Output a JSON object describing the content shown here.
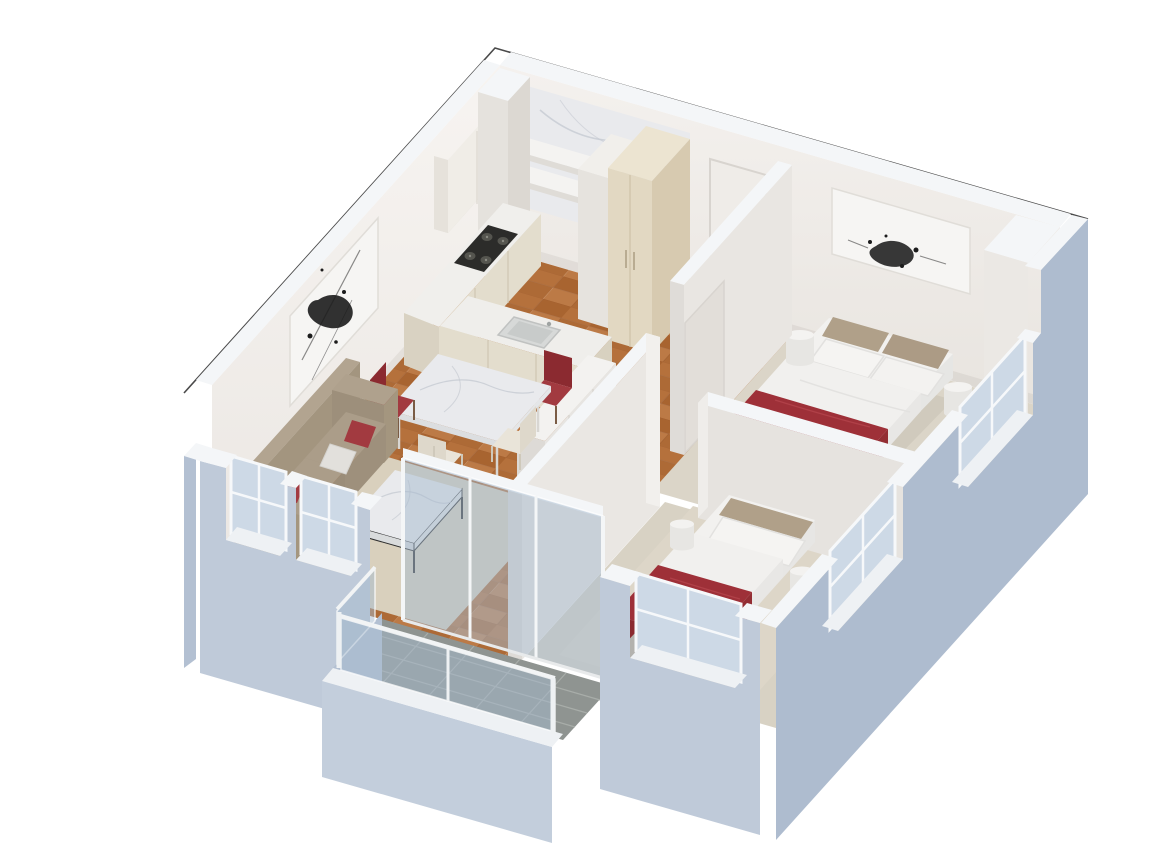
{
  "meta": {
    "width": 1170,
    "height": 859,
    "view": "3d-isometric-cutaway-floor-plan",
    "style": "architectural render, white background",
    "background": "#ffffff"
  },
  "palette": {
    "wood_1": "#b5713c",
    "wood_2": "#a86430",
    "wood_3": "#ad6a36",
    "wood_4": "#bc7a46",
    "carpet_bedroom1": "#dbd5c8",
    "carpet_bedroom2": "#d8d2c4",
    "rug_living": "#d9d0bd",
    "rug_bedroom2": "#ddd6c8",
    "balcony_tile": "#8f9491",
    "balcony_grout": "#a8ada9",
    "marble": "#e9eaed",
    "marble_vein": "#c6cad2",
    "linen_white": "#f2f1ef",
    "accent_red": "#9e3038",
    "accent_red_dark": "#8b2a30",
    "accent_red_mid": "#932d33",
    "pillow_red": "#a23a40",
    "sofa_taupe": "#ab9d89",
    "headboard_taupe": "#b0a089",
    "window_glass": "#cdd9e6",
    "balustrade_glass": "rgba(165,185,205,0.5)",
    "exterior_sw": "#bfcad9",
    "exterior_se": "#aebccf",
    "exterior_w": "#b3c0d2",
    "wall_top": "#f4f6f8",
    "window_sill": "#eef1f4",
    "window_frame": "#f6f8fa",
    "interior_wall_light": "#f4f1ee",
    "interior_wall_shade": "#e8e4df",
    "cabinet_cream": "#e3ddcd",
    "cabinet_beige": "#e2d8c2",
    "stove_black": "#2c2c2a",
    "threshold_dark": "#3f403e",
    "artwork_ink": "#1c1c1c",
    "cut_outline": "#4a4a4a"
  },
  "scene": {
    "rooms": [
      {
        "id": "kitchen",
        "name": "kitchen",
        "floor": "wood-parquet",
        "furniture": [
          "marble-backsplash",
          "open-shelves",
          "upper-cabinets",
          "stove-counter",
          "sink-counter",
          "tall-beige-cabinet",
          "duct-column",
          "white-cabinet"
        ]
      },
      {
        "id": "entry-hall",
        "name": "entry hall",
        "floor": "wood-parquet",
        "furniture": [
          "entry-door"
        ]
      },
      {
        "id": "bedroom-1",
        "name": "master bedroom",
        "floor": "carpet",
        "furniture": [
          "double-bed-red-blanket",
          "nightstand-left",
          "nightstand-right",
          "ink-artwork",
          "corner-shaft",
          "sash-window"
        ]
      },
      {
        "id": "corridor",
        "name": "corridor",
        "floor": "wood-parquet",
        "furniture": [
          "white-sideboard"
        ]
      },
      {
        "id": "bedroom-2",
        "name": "bedroom",
        "floor": "carpet",
        "furniture": [
          "bed-red-blanket",
          "side-table-left",
          "side-table-right",
          "foot-bench",
          "area-rug",
          "sash-window"
        ]
      },
      {
        "id": "living-dining",
        "name": "living and dining room",
        "floor": "wood-parquet",
        "furniture": [
          "taupe-sofa",
          "red-pillows",
          "white-pillow",
          "marble-coffee-table",
          "marble-dining-table",
          "red-dining-chairs",
          "cream-dining-chairs",
          "ink-artwork",
          "area-rug",
          "sash-windows"
        ]
      },
      {
        "id": "balcony",
        "name": "balcony",
        "floor": "stone-tile",
        "furniture": [
          "glass-balustrade",
          "glass-sliding-door",
          "threshold-grate"
        ]
      }
    ]
  }
}
